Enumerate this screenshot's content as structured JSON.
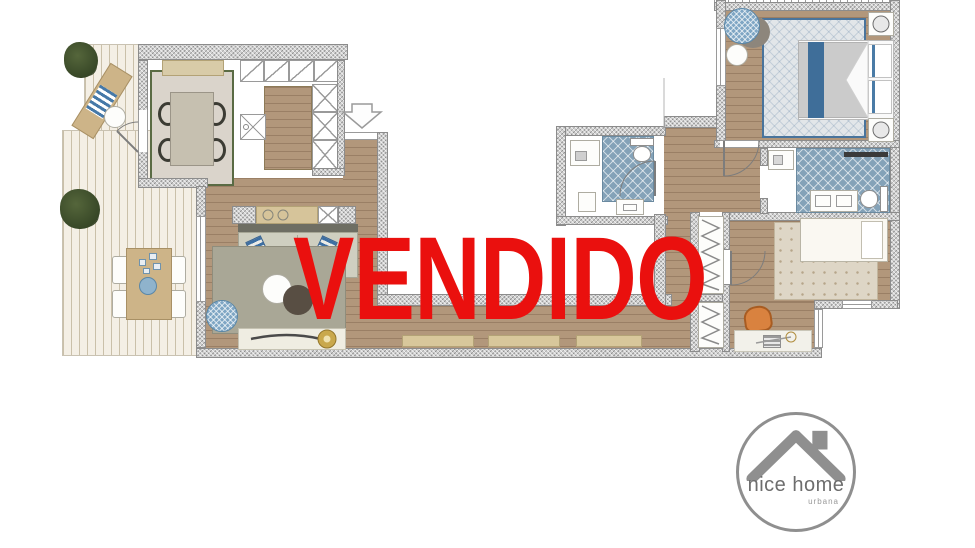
{
  "stamp": {
    "label": "VENDIDO",
    "color": "#ea100e"
  },
  "logo": {
    "title": "nice home",
    "subtitle": "urbana",
    "ring_color": "#8f8f8f",
    "title_color": "#6d6d6d",
    "subtitle_color": "#9a9a9a",
    "roof_icon": "house-roof-icon"
  },
  "icons": {
    "entrance": "entrance-arrow-icon",
    "door_swings": "door-arc-icon",
    "wardrobe_rail": "zigzag-rail-icon"
  },
  "palette": {
    "sold_red": "#ea100e",
    "wall_hatch": "#cfcfcf",
    "interior_wood": "#b2977b",
    "terrace_deck": "#f4efe5",
    "bathroom_tile": "#84a2b8",
    "accent_blue": "#3f6e99",
    "counter_tan": "#d6c49a",
    "rug_living": "#a9a796",
    "rug_dining": "#dad4cb",
    "rug_master": "#e2e6e9",
    "rug_kids": "#ded6c6",
    "desk_chair_orange": "#d9823f",
    "plant_green": "#3c4c2a",
    "gold_accent": "#c9a84c"
  }
}
